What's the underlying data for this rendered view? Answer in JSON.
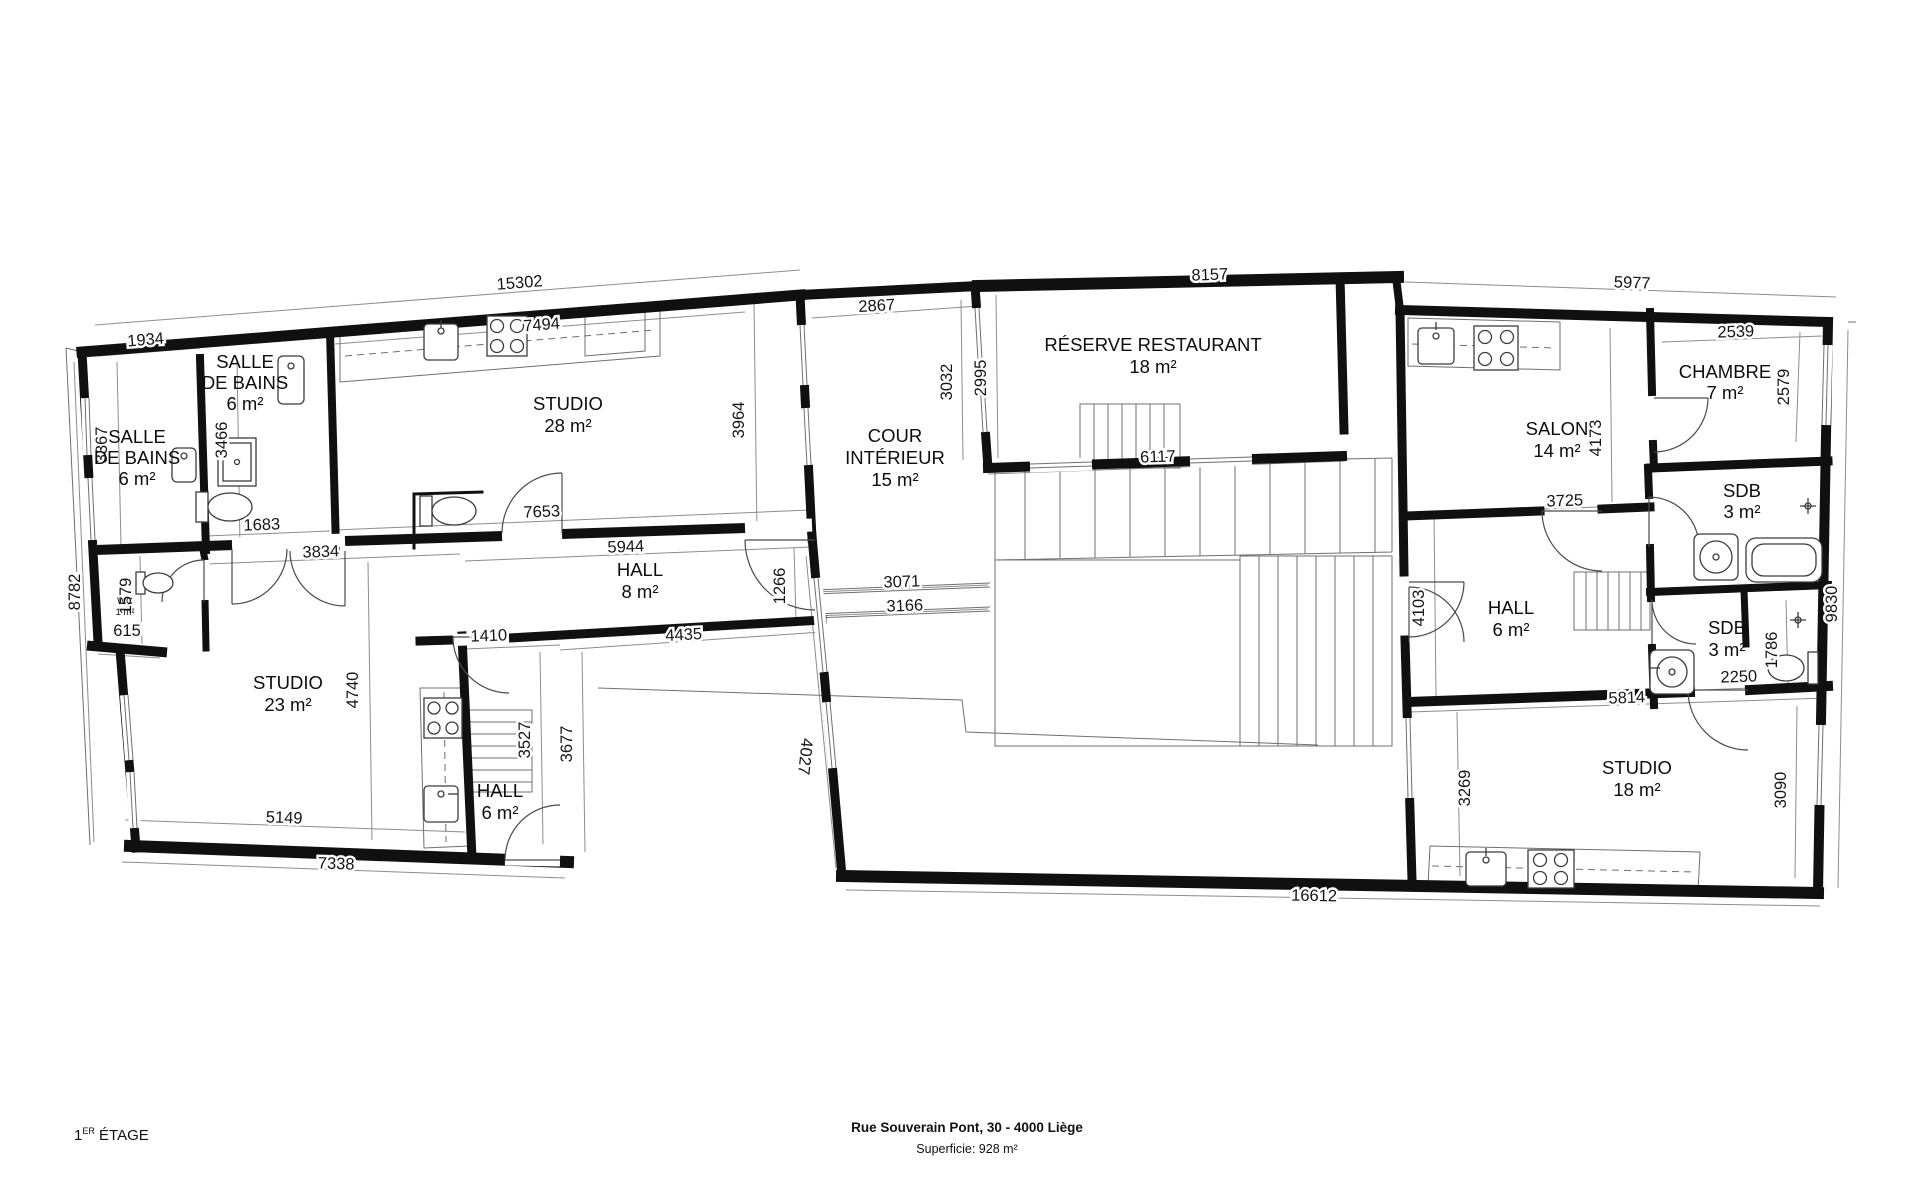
{
  "colors": {
    "wall": "#101010",
    "background": "#ffffff",
    "dim_line": "#8c8c8c",
    "text": "#111111"
  },
  "plan": {
    "floor_num": "1",
    "floor_sup": "ER",
    "floor_word": "ÉTAGE",
    "address": "Rue Souverain Pont, 30 - 4000 Liège",
    "surface": "Superficie: 928 m²"
  },
  "rooms": [
    {
      "l1": "SALLE",
      "l2": "DE BAINS",
      "area": "6 m²"
    },
    {
      "l1": "SALLE",
      "l2": "DE BAINS",
      "area": "6 m²"
    },
    {
      "l1": "WC",
      "l2": "",
      "area": "1 m²"
    },
    {
      "l1": "STUDIO",
      "l2": "",
      "area": "28 m²"
    },
    {
      "l1": "COUR",
      "l2": "INTÉRIEUR",
      "area": "15 m²"
    },
    {
      "l1": "RÉSERVE RESTAURANT",
      "l2": "",
      "area": "18 m²"
    },
    {
      "l1": "HALL",
      "l2": "",
      "area": "8 m²"
    },
    {
      "l1": "STUDIO",
      "l2": "",
      "area": "23 m²"
    },
    {
      "l1": "HALL",
      "l2": "",
      "area": "6 m²"
    },
    {
      "l1": "SALON",
      "l2": "",
      "area": "14 m²"
    },
    {
      "l1": "CHAMBRE",
      "l2": "",
      "area": "7 m²"
    },
    {
      "l1": "SDB",
      "l2": "",
      "area": "3 m²"
    },
    {
      "l1": "HALL",
      "l2": "",
      "area": "6 m²"
    },
    {
      "l1": "SDB",
      "l2": "",
      "area": "3 m²"
    },
    {
      "l1": "STUDIO",
      "l2": "",
      "area": "18 m²"
    }
  ],
  "dims": [
    "15302",
    "1934",
    "7494",
    "2867",
    "8157",
    "5977",
    "2539",
    "2579",
    "3367",
    "3466",
    "3964",
    "3032",
    "2995",
    "6117",
    "4173",
    "3725",
    "7653",
    "1683",
    "3834",
    "5944",
    "1266",
    "3071",
    "3166",
    "4435",
    "1410",
    "8782",
    "1579",
    "615",
    "4740",
    "3527",
    "3677",
    "4027",
    "5149",
    "7338",
    "5814",
    "2250",
    "1786",
    "3269",
    "3090",
    "16612",
    "9830",
    "4103"
  ]
}
